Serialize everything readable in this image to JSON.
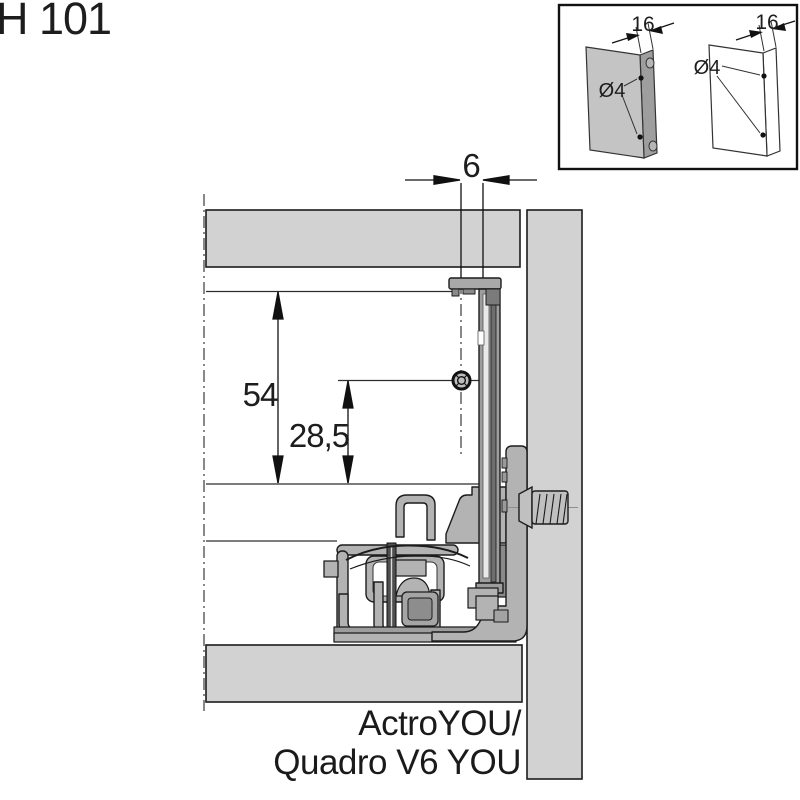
{
  "title": "H 101",
  "diagram": {
    "dimensions": {
      "front_gap": "6",
      "height_total": "54",
      "height_hole": "28,5"
    },
    "product_label": [
      "ActroYOU/",
      "Quadro V6 YOU"
    ],
    "colors": {
      "panel_fill": "#d2d2d2",
      "mechanism_fill": "#b3b3b3",
      "rail_fill": "#9d9d9d",
      "outline": "#1c1c1c"
    }
  },
  "inset": {
    "panels": [
      {
        "style": "solid-gray",
        "thickness": "16",
        "hole_diameter": "Ø4"
      },
      {
        "style": "outline",
        "thickness": "16",
        "hole_diameter": "Ø4"
      }
    ]
  }
}
